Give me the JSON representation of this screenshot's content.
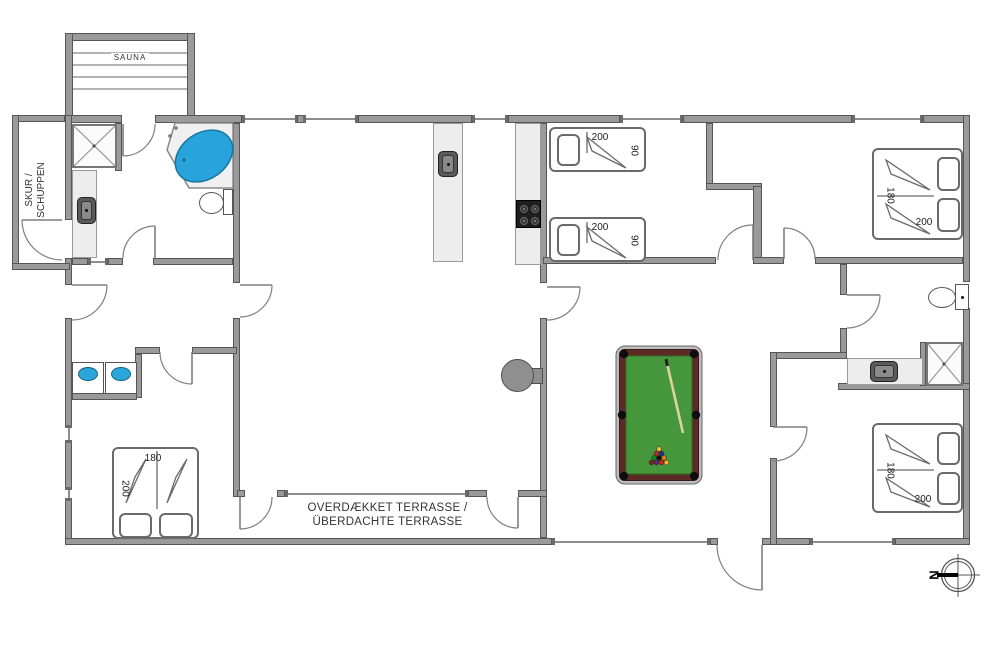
{
  "rooms": {
    "sauna": "SAUNA",
    "shed_line1": "SKUR /",
    "shed_line2": "SCHUPPEN",
    "terrace_line1": "OVERDÆKKET TERRASSE /",
    "terrace_line2": "ÜBERDACHTE TERRASSE"
  },
  "beds": {
    "kids1": {
      "length": "200",
      "width": "90"
    },
    "kids2": {
      "length": "200",
      "width": "90"
    },
    "top_right": {
      "width": "180",
      "length": "200"
    },
    "bottom_right": {
      "width": "180",
      "length": "200"
    },
    "bottom_left": {
      "width": "180",
      "length": "200"
    }
  },
  "compass": {
    "north": "N"
  },
  "colors": {
    "wall_gray": "#9a9a9a",
    "wall_edge": "#565656",
    "water_blue": "#29a3dc",
    "pool_felt": "#46963c",
    "pool_rail": "#5d2a26",
    "counter_gray": "#ededed"
  }
}
